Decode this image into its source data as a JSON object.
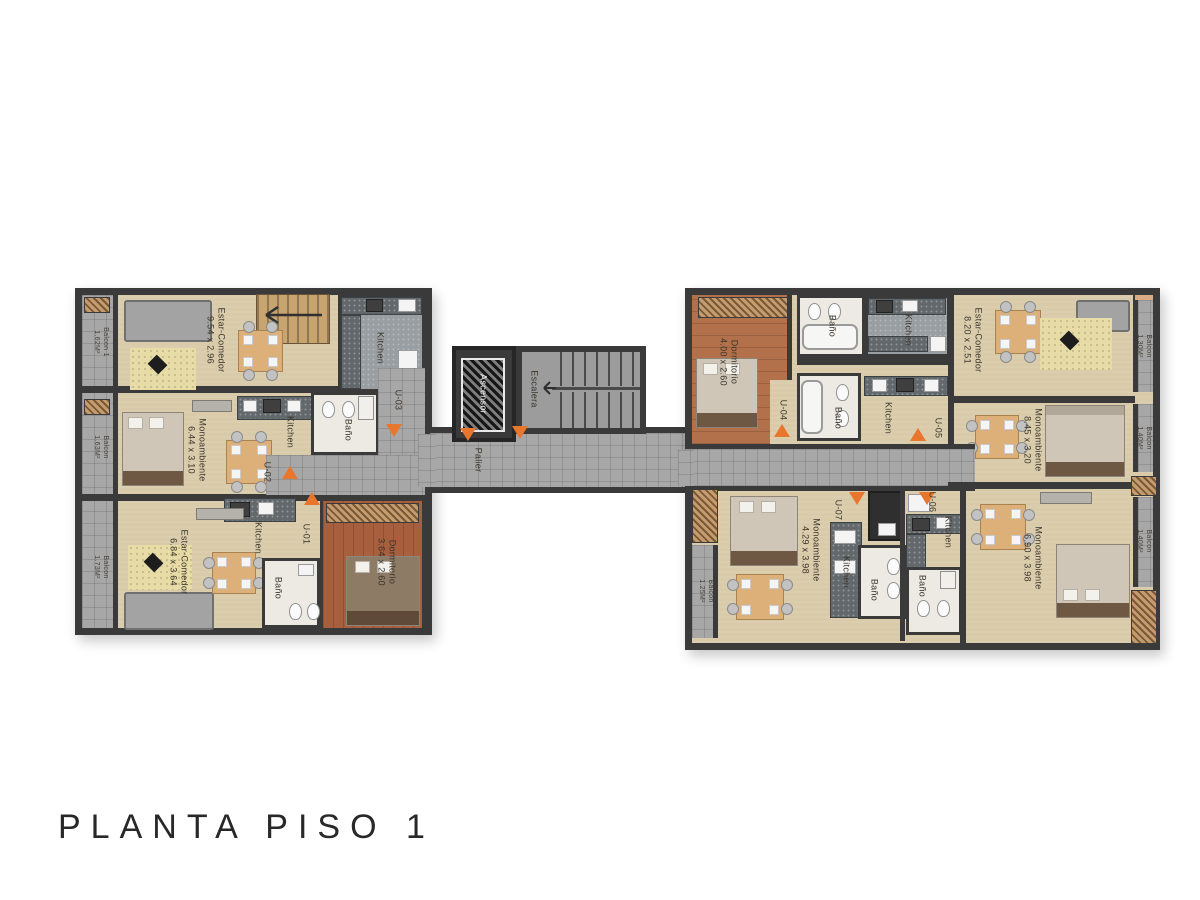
{
  "title": "PLANTA PISO 1",
  "core": {
    "elevator": "Ascensor",
    "stairs": "Escalera",
    "landing": "Palier"
  },
  "units": {
    "u01": {
      "id": "U-01",
      "living": "Estar-Comedor",
      "living_dims": "6.84 x 3.64",
      "kitchen": "Kitchen",
      "bath": "Baño",
      "bedroom": "Dormitorio",
      "bedroom_dims": "3.64 x 2.60",
      "balcony": "Balcon",
      "balcony_area": "1.73M²"
    },
    "u02": {
      "id": "U-02",
      "main": "Monoambiente",
      "main_dims": "6.44 x 3.10",
      "kitchen": "Kitchen",
      "bath": "Baño",
      "balcony": "Balcon",
      "balcony_area": "1.63M²"
    },
    "u03": {
      "id": "U-03",
      "living": "Estar-Comedor",
      "living_dims": "9.54 x 2.96",
      "kitchen": "Kitchen",
      "balcony": "Balcon 1",
      "balcony_area": "1.62M²"
    },
    "u04": {
      "id": "U-04",
      "bedroom": "Dormitorio",
      "bedroom_dims": "4.00 x 2.60",
      "bath": "Baño",
      "kitchen": "Kitchen",
      "living": "Estar-Comedor",
      "living_dims": "8.20 x 2.51",
      "balcony": "Balcon",
      "balcony_area": "1.30M²"
    },
    "u05": {
      "id": "U-05",
      "bath": "Baño",
      "kitchen": "Kitchen",
      "main": "Monoambiente",
      "main_dims": "8.45 x 3.20",
      "balcony": "Balcon",
      "balcony_area": "1.40M²"
    },
    "u06": {
      "id": "U-06",
      "kitchen": "Kitchen",
      "bath": "Baño",
      "main": "Monoambiente",
      "main_dims": "6.90 x 3.98",
      "balcony": "Balcon",
      "balcony_area": "1.40M²"
    },
    "u07": {
      "id": "U-07",
      "main": "Monoambiente",
      "main_dims": "4.29 x 3.98",
      "kitchen": "Kitchen",
      "bath": "Baño",
      "balcony": "Balcon",
      "balcony_area": "1.25M²"
    }
  },
  "colors": {
    "wall": "#3a3a3a",
    "floor": "#d9cbaa",
    "tile": "#a7a7a7",
    "wood": "#b3714b",
    "accent": "#e8762c"
  }
}
